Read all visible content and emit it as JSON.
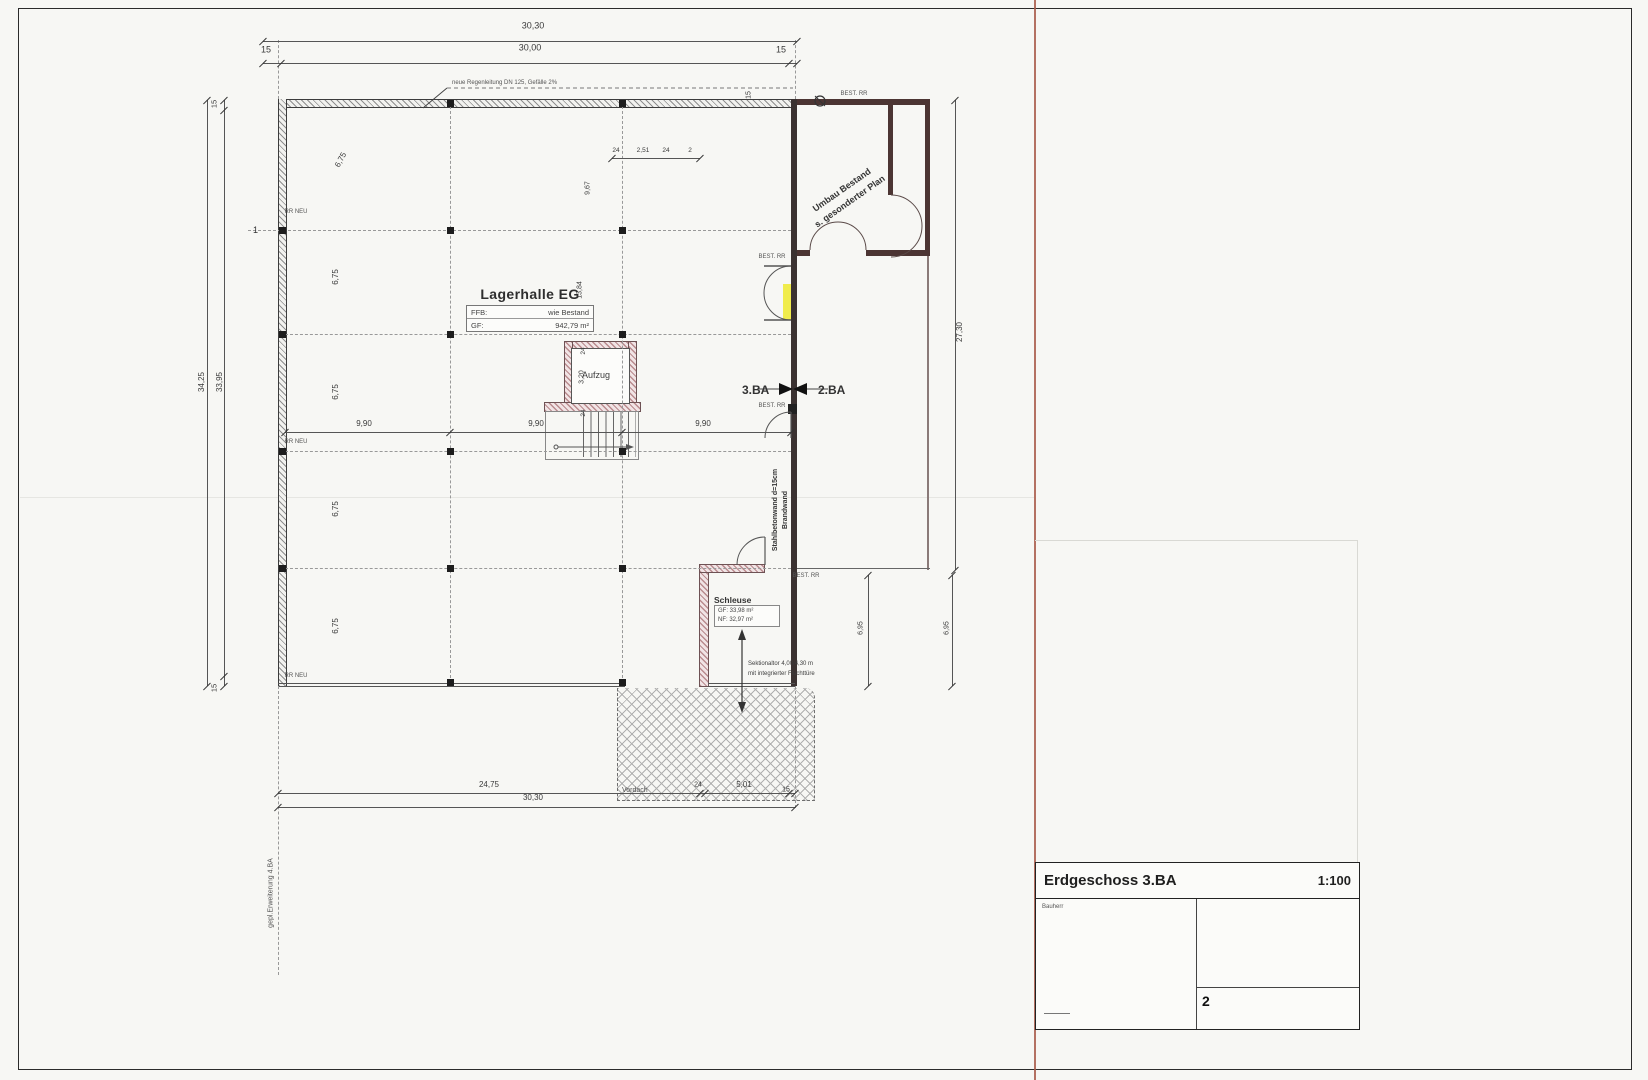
{
  "drawing": {
    "title": "Erdgeschoss 3.BA",
    "scale": "1:100",
    "sheet_number": "2",
    "title_block": {
      "left_cell_label": "Bauherr"
    }
  },
  "rooms": {
    "lagerhalle": {
      "name": "Lagerhalle EG",
      "ffb_label": "FFB:",
      "ffb_value": "wie Bestand",
      "gf_label": "GF:",
      "gf_value": "942,79 m²"
    },
    "schleuse": {
      "name": "Schleuse",
      "gf": "GF: 33,98 m²",
      "nf": "NF: 32,97 m²"
    },
    "aufzug": {
      "name": "Aufzug"
    },
    "vordach": {
      "name": "Vordach"
    }
  },
  "phase_labels": {
    "left": "3.BA",
    "right": "2.BA"
  },
  "annotations": {
    "umbau_line1": "Umbau Bestand",
    "umbau_line2": "s. gesonderter Plan",
    "brandwand_line1": "Stahlbetonwand d=15cm",
    "brandwand_line2": "Brandwand",
    "tor_line1": "Sektionaltor 4,00/4,30 m",
    "tor_line2": "mit integrierter Fluchttüre",
    "regenleitung": "neue Regenleitung DN 125, Gefälle 2%",
    "erweiterung": "gepl.Erweiterung 4.BA",
    "axis_1": "1"
  },
  "colors": {
    "highlight_yellow": "#f0ec4c",
    "existing_wall": "#4c3533",
    "new_wall_hatch": "#b98b8e",
    "fold_line": "#a85948"
  },
  "dim_labels": [
    {
      "t": "30,30",
      "x": 533,
      "y": 26,
      "r": 0,
      "s": 9
    },
    {
      "t": "15",
      "x": 266,
      "y": 50,
      "r": 0,
      "s": 9
    },
    {
      "t": "30,00",
      "x": 530,
      "y": 48,
      "r": 0,
      "s": 9
    },
    {
      "t": "15",
      "x": 781,
      "y": 50,
      "r": 0,
      "s": 9
    },
    {
      "t": "15",
      "x": 749,
      "y": 95,
      "r": -90,
      "s": 7
    },
    {
      "t": "24",
      "x": 616,
      "y": 151,
      "r": 0,
      "s": 6.5
    },
    {
      "t": "2,51",
      "x": 643,
      "y": 151,
      "r": 0,
      "s": 6.5
    },
    {
      "t": "24",
      "x": 666,
      "y": 151,
      "r": 0,
      "s": 6.5
    },
    {
      "t": "2",
      "x": 690,
      "y": 151,
      "r": 0,
      "s": 6.5
    },
    {
      "t": "9,67",
      "x": 588,
      "y": 188,
      "r": -90,
      "s": 7
    },
    {
      "t": "13,84",
      "x": 580,
      "y": 290,
      "r": -90,
      "s": 7
    },
    {
      "t": "3,20",
      "x": 582,
      "y": 377,
      "r": -90,
      "s": 7
    },
    {
      "t": "24",
      "x": 584,
      "y": 351,
      "r": -90,
      "s": 6.5
    },
    {
      "t": "24",
      "x": 584,
      "y": 413,
      "r": -90,
      "s": 6.5
    },
    {
      "t": "6,75",
      "x": 341,
      "y": 160,
      "r": -62,
      "s": 8
    },
    {
      "t": "6,75",
      "x": 336,
      "y": 277,
      "r": -90,
      "s": 8
    },
    {
      "t": "6,75",
      "x": 336,
      "y": 392,
      "r": -90,
      "s": 8
    },
    {
      "t": "6,75",
      "x": 336,
      "y": 509,
      "r": -90,
      "s": 8
    },
    {
      "t": "6,75",
      "x": 336,
      "y": 626,
      "r": -90,
      "s": 8
    },
    {
      "t": "9,90",
      "x": 364,
      "y": 424,
      "r": 0,
      "s": 8
    },
    {
      "t": "9,90",
      "x": 536,
      "y": 424,
      "r": 0,
      "s": 8
    },
    {
      "t": "9,90",
      "x": 703,
      "y": 424,
      "r": 0,
      "s": 8
    },
    {
      "t": "34,25",
      "x": 202,
      "y": 382,
      "r": -90,
      "s": 8
    },
    {
      "t": "15",
      "x": 214,
      "y": 104,
      "r": -90,
      "s": 7.5
    },
    {
      "t": "33,95",
      "x": 220,
      "y": 382,
      "r": -90,
      "s": 8
    },
    {
      "t": "15",
      "x": 214,
      "y": 688,
      "r": -90,
      "s": 7.5
    },
    {
      "t": "27,30",
      "x": 960,
      "y": 332,
      "r": -90,
      "s": 8
    },
    {
      "t": "6,95",
      "x": 861,
      "y": 628,
      "r": -90,
      "s": 7
    },
    {
      "t": "6,95",
      "x": 947,
      "y": 628,
      "r": -90,
      "s": 7
    },
    {
      "t": "24,75",
      "x": 489,
      "y": 785,
      "r": 0,
      "s": 8
    },
    {
      "t": "24",
      "x": 698,
      "y": 785,
      "r": 0,
      "s": 7
    },
    {
      "t": "5,01",
      "x": 744,
      "y": 785,
      "r": 0,
      "s": 8
    },
    {
      "t": "15",
      "x": 786,
      "y": 790,
      "r": 0,
      "s": 7
    },
    {
      "t": "30,30",
      "x": 533,
      "y": 798,
      "r": 0,
      "s": 8
    }
  ],
  "tiny_labels": [
    {
      "t": "BEST. RR",
      "x": 854,
      "y": 94
    },
    {
      "t": "BEST. RR",
      "x": 772,
      "y": 257
    },
    {
      "t": "BEST. RR",
      "x": 772,
      "y": 406
    },
    {
      "t": "BEST. RR",
      "x": 806,
      "y": 576
    },
    {
      "t": "RR NEU",
      "x": 296,
      "y": 212
    },
    {
      "t": "RR NEU",
      "x": 296,
      "y": 442
    },
    {
      "t": "RR NEU",
      "x": 296,
      "y": 676
    }
  ]
}
